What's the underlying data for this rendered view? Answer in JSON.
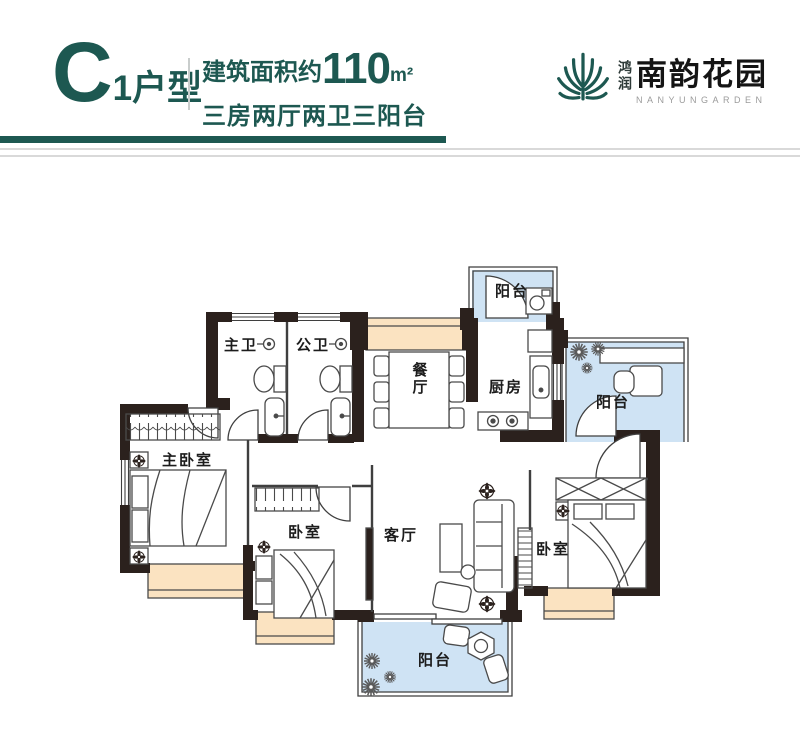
{
  "header": {
    "unit_letter": "C",
    "unit_suffix": "1户型",
    "area_prefix": "建筑面积约",
    "area_value": "110",
    "area_unit": "m²",
    "layout_desc": "三房两厅两卫三阳台"
  },
  "logo": {
    "brand_vertical": "鸿润",
    "brand_name": "南韵花园",
    "brand_en": "NANYUNGARDEN"
  },
  "floorplan": {
    "rooms": [
      {
        "id": "balcony-top",
        "label": "阳台"
      },
      {
        "id": "bath-master",
        "label": "主卫"
      },
      {
        "id": "bath-public",
        "label": "公卫"
      },
      {
        "id": "dining",
        "label": "餐厅"
      },
      {
        "id": "kitchen",
        "label": "厨房"
      },
      {
        "id": "balcony-right",
        "label": "阳台"
      },
      {
        "id": "master-bedroom",
        "label": "主卧室"
      },
      {
        "id": "bedroom-center",
        "label": "卧室"
      },
      {
        "id": "living",
        "label": "客厅"
      },
      {
        "id": "bedroom-right",
        "label": "卧室"
      },
      {
        "id": "balcony-bottom",
        "label": "阳台"
      }
    ]
  },
  "colors": {
    "accent_teal": "#1d5851",
    "wall_black": "#2b211d",
    "balcony_blue": "#cfe3f4",
    "bay_window_beige": "#fbe3c1"
  }
}
